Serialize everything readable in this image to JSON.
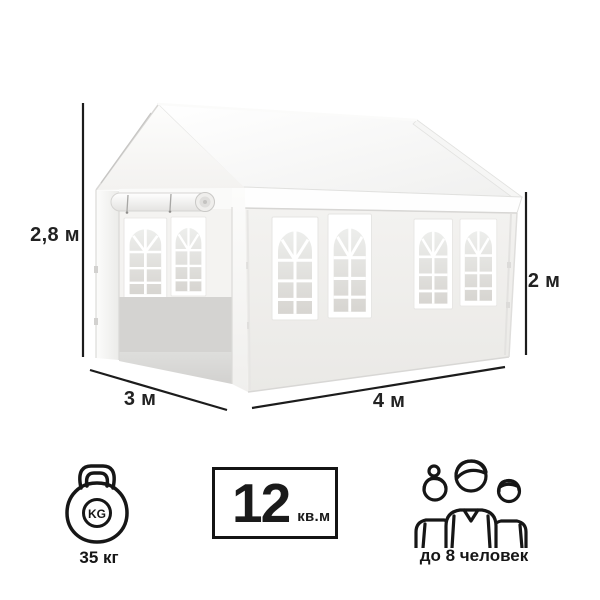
{
  "dimensions": {
    "height": "2,8 м",
    "wall_height": "2 м",
    "depth": "3 м",
    "width": "4 м"
  },
  "specs": {
    "weight": {
      "icon": "kettlebell-icon",
      "badge": "KG",
      "label": "35 кг"
    },
    "area": {
      "value": "12",
      "unit": "кв.м"
    },
    "capacity": {
      "icon": "people-icon",
      "label": "до 8 человек"
    }
  },
  "colors": {
    "background": "#ffffff",
    "dimension_line": "#1c1c1c",
    "label_text": "#222222",
    "icon_stroke": "#161616",
    "tent_wall": "#f0efed",
    "tent_roof": "#fafafa",
    "window_glass": "#dcdad6"
  }
}
